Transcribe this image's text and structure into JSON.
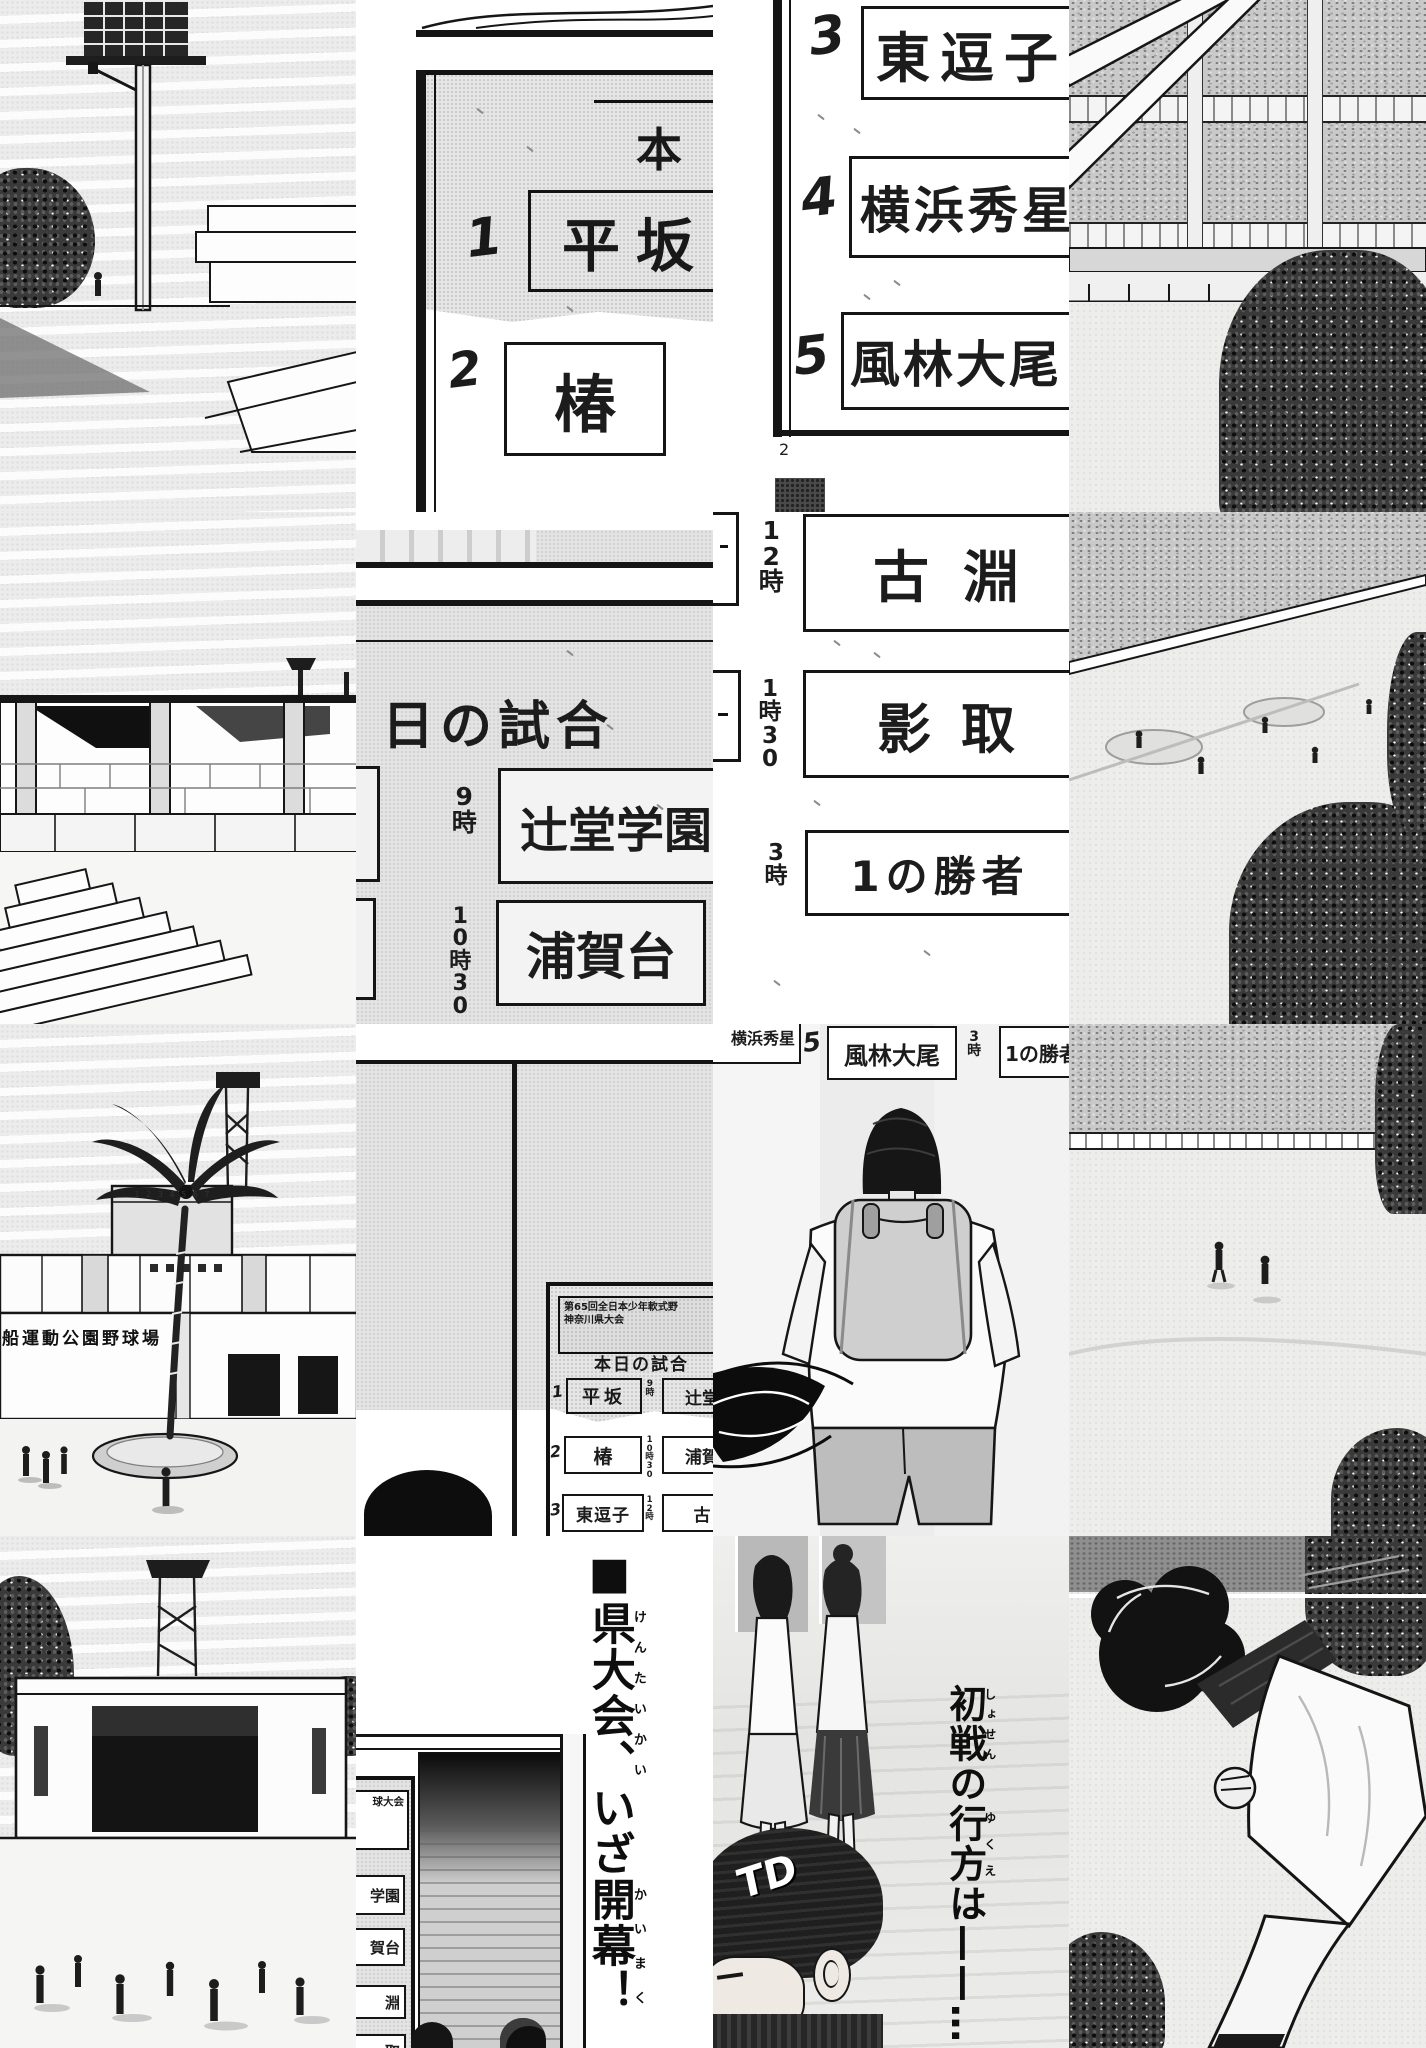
{
  "canvas": {
    "width": 1426,
    "height": 2048
  },
  "palette": {
    "ink": "#1c1c1c",
    "paper": "#ffffff",
    "halftone_sky": "#ececec",
    "sign_gray": "#e3e3e3",
    "crowd_gray": "#c9c9c9",
    "foliage_dark": "#3a3a3a"
  },
  "tiles": {
    "r1c2_schedule_sign_top": {
      "header_fragment": "本",
      "entries": [
        {
          "num": "1",
          "team": "平坂"
        },
        {
          "num": "2",
          "team": "椿"
        }
      ]
    },
    "r1c3_schedule_sign_list": {
      "entries": [
        {
          "num": "3",
          "team": "東逗子"
        },
        {
          "num": "4",
          "team": "横浜秀星"
        },
        {
          "num": "5",
          "team": "風林大尾"
        }
      ],
      "page_number": "2"
    },
    "r2c2_schedule_sign_times": {
      "title_fragment": "日の試合",
      "entries": [
        {
          "time": "9時",
          "team": "辻堂学園"
        },
        {
          "time": "10時30",
          "team": "浦賀台"
        }
      ]
    },
    "r2c3_schedule_sign_times": {
      "entries": [
        {
          "time": "12時",
          "team": "古淵"
        },
        {
          "time": "1時30",
          "team": "影取"
        },
        {
          "time": "3時",
          "team": "1の勝者"
        }
      ]
    },
    "r3c1_stadium_entrance": {
      "building_sign": "船運動公園野球場",
      "scoreboard_digits": "1 2 3 4 5 6 7"
    },
    "r3c2_notice_board": {
      "board": {
        "header_line1": "第65回全日本少年軟式野",
        "header_line2": "神奈川県大会",
        "title": "本日の試合",
        "rows": [
          {
            "num": "1",
            "team": "平坂",
            "time": "9時",
            "opponent": "辻堂"
          },
          {
            "num": "2",
            "team": "椿",
            "time": "10時30",
            "opponent": "浦賀"
          },
          {
            "num": "3",
            "team": "東逗子",
            "time": "12時",
            "opponent": "古"
          },
          {
            "num": "4",
            "team": "横浜秀星",
            "time": "1時",
            "opponent": "影"
          }
        ]
      }
    },
    "r3c3_backpack_boy": {
      "fragments": {
        "team_left": "横浜秀星",
        "num": "5",
        "team_mid": "風林大尾",
        "time": "3時",
        "team_right": "1の勝者"
      }
    },
    "r4c2_headline_tile": {
      "sign_fragments": {
        "header": "球大会",
        "rows": [
          "学園",
          "賀台",
          "淵",
          "取"
        ]
      },
      "headline": {
        "prefix": "■",
        "seg1": "県大会、",
        "ruby1": "けんたいかい",
        "seg2": "いざ",
        "seg3": "開幕！",
        "ruby3": "かいまく"
      }
    },
    "r4c3_headline_tile": {
      "headline": {
        "seg1": "初戦",
        "ruby1": "しょせん",
        "seg2": "の",
        "seg3": "行方",
        "ruby2": "ゆくえ",
        "seg4": "は——…"
      },
      "cap_logo": "TD"
    }
  }
}
